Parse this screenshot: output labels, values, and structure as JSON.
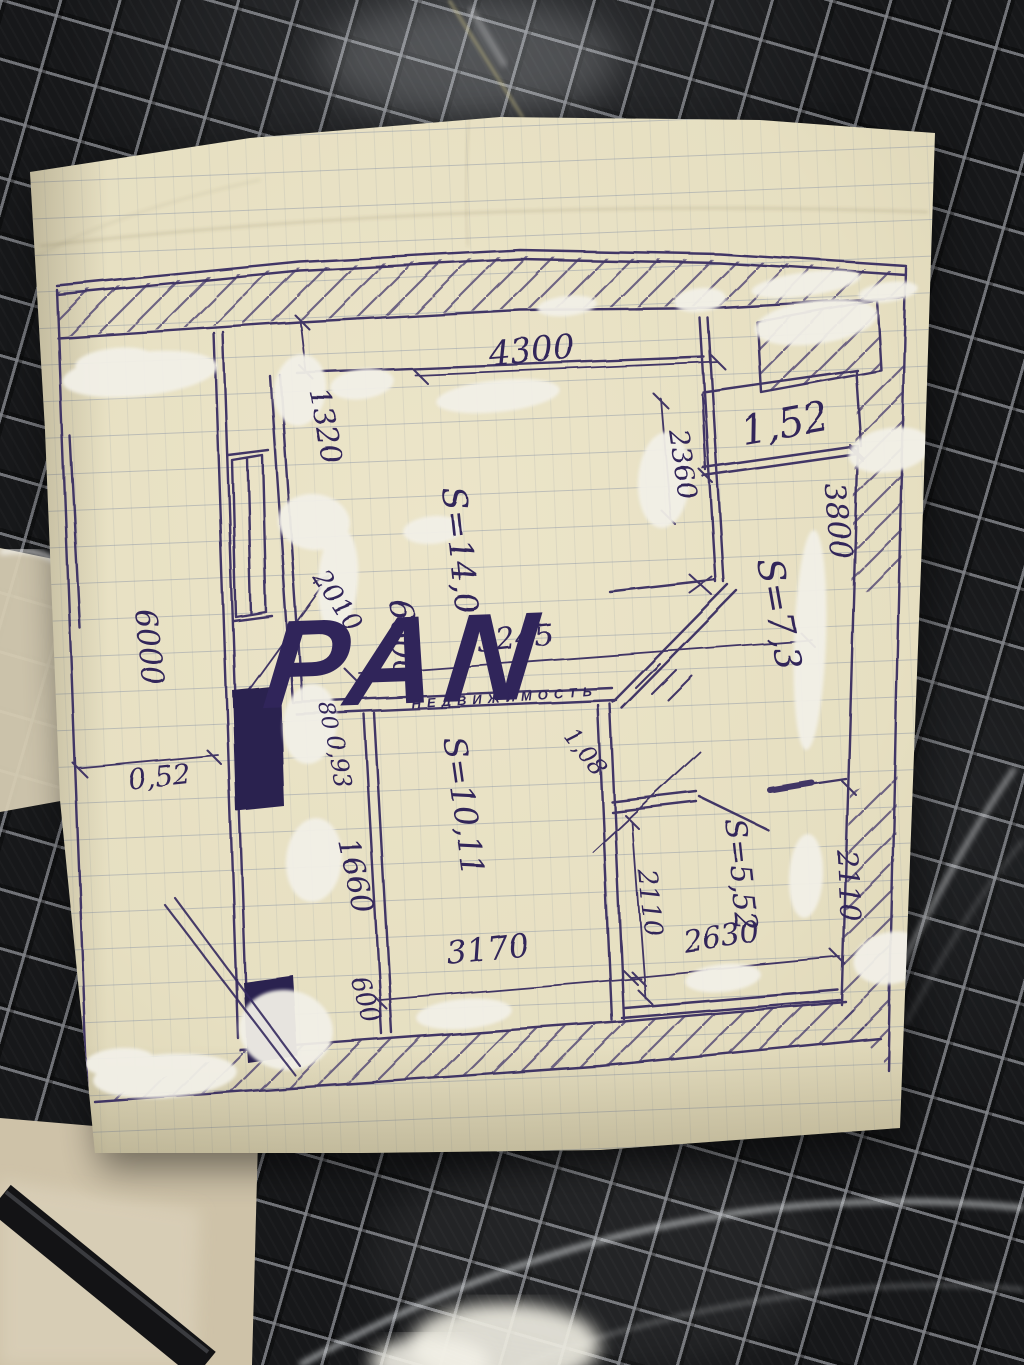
{
  "photo": {
    "subject": "hand-drawn apartment floor plan sketch on ruled notebook paper",
    "palette": {
      "ink": "#362a5f",
      "paper": "#e8e1c4",
      "whiteout": "#f2f0e7",
      "tile": "#17181a",
      "grout": "#6e7074",
      "watermark": "#ffffff"
    }
  },
  "floor_plan": {
    "watermark": {
      "text": "PAN",
      "subtext": "НЕДВИЖИМОСТЬ"
    },
    "room_areas": [
      {
        "id": "main-room",
        "label": "S=14,0"
      },
      {
        "id": "right-room",
        "label": "S=7,3"
      },
      {
        "id": "bottom-room",
        "label": "S=10,11"
      },
      {
        "id": "bottom-right-room",
        "label": "S=5,52"
      },
      {
        "id": "loggia",
        "label": "1,52"
      }
    ],
    "dimensions": [
      {
        "id": "top-width",
        "label": "4300"
      },
      {
        "id": "left-top",
        "label": "1320"
      },
      {
        "id": "hall-height",
        "label": "2360"
      },
      {
        "id": "right-height",
        "label": "3800"
      },
      {
        "id": "room-height",
        "label": "6600"
      },
      {
        "id": "room-width",
        "label": "3245"
      },
      {
        "id": "pier-diagonal",
        "label": "2010"
      },
      {
        "id": "left-strip",
        "label": "6000"
      },
      {
        "id": "strip-width",
        "label": "0,52"
      },
      {
        "id": "small-80",
        "label": "80"
      },
      {
        "id": "small-093",
        "label": "0,93"
      },
      {
        "id": "bottom-left-wall",
        "label": "1660"
      },
      {
        "id": "bottom-left-600",
        "label": "600"
      },
      {
        "id": "passage",
        "label": "1,08"
      },
      {
        "id": "bottom-width",
        "label": "3170"
      },
      {
        "id": "br-room-width",
        "label": "2630"
      },
      {
        "id": "br-room-height-inner",
        "label": "2110"
      },
      {
        "id": "br-room-height-outer",
        "label": "2110"
      }
    ]
  }
}
